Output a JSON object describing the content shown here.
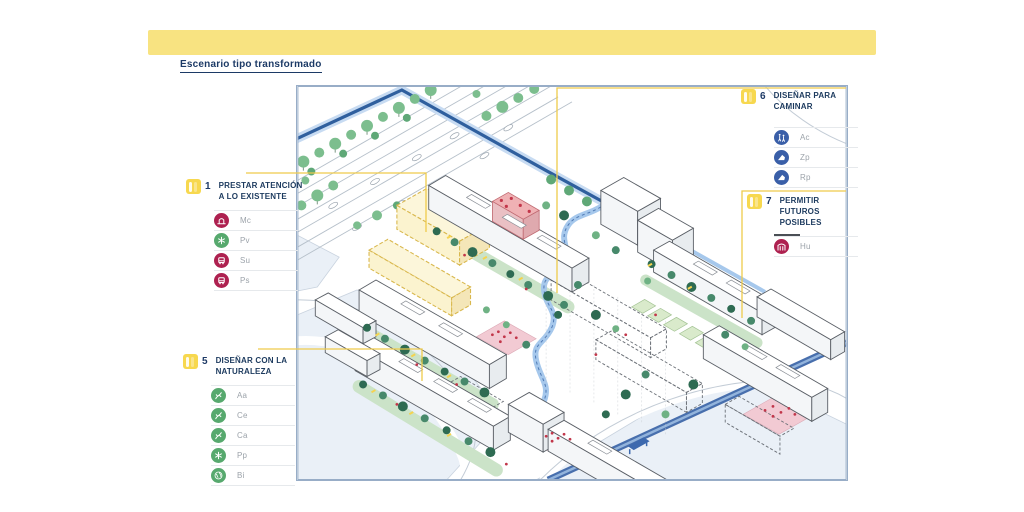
{
  "title": "Escenario tipo transformado",
  "callouts": {
    "c1": {
      "number": "1",
      "title": "PRESTAR ATENCIÓN A LO EXISTENTE",
      "items": [
        {
          "code": "Mc",
          "icon": "monument-icon",
          "color": "#AE2150"
        },
        {
          "code": "Pv",
          "icon": "plant-icon",
          "color": "#57A96E"
        },
        {
          "code": "Su",
          "icon": "bus-icon",
          "color": "#AE2150"
        },
        {
          "code": "Ps",
          "icon": "bus-icon",
          "color": "#AE2150"
        }
      ]
    },
    "c5": {
      "number": "5",
      "title": "DISEÑAR CON LA NATURALEZA",
      "items": [
        {
          "code": "Aa",
          "icon": "branch-icon",
          "color": "#57A96E"
        },
        {
          "code": "Ce",
          "icon": "branch-icon",
          "color": "#57A96E"
        },
        {
          "code": "Ca",
          "icon": "branch-icon",
          "color": "#57A96E"
        },
        {
          "code": "Pp",
          "icon": "plant-icon",
          "color": "#57A96E"
        },
        {
          "code": "Bi",
          "icon": "globe-icon",
          "color": "#57A96E"
        }
      ]
    },
    "c6": {
      "number": "6",
      "title": "DISEÑAR PARA CAMINAR",
      "items": [
        {
          "code": "Ac",
          "icon": "pedestrians-icon",
          "color": "#3A5FA8"
        },
        {
          "code": "Zp",
          "icon": "footpath-icon",
          "color": "#3A5FA8"
        },
        {
          "code": "Rp",
          "icon": "footpath-icon",
          "color": "#3A5FA8"
        }
      ]
    },
    "c7": {
      "number": "7",
      "title": "PERMITIR FUTUROS POSIBLES",
      "items": [
        {
          "code": "Hu",
          "icon": "arch-icon",
          "color": "#AE2150"
        }
      ]
    }
  },
  "colors": {
    "banner": "#F8E381",
    "badge_yellow": "#F7D84F",
    "connector_yellow": "#EFCB4B",
    "navy_text": "#1C3A5E",
    "label_gray": "#9CA3AA",
    "crimson": "#AE2150",
    "green": "#57A96E",
    "blue": "#3A5FA8",
    "map_border": "#98ADC7",
    "canal_blue": "#2F5F9E",
    "path_blue": "#A6C8EC",
    "highlight_yellow_fill": "#FBF3CF",
    "highlight_red_fill": "#EFB1B4",
    "plaza_pink": "#F2CAD3",
    "tree_dark": "#2E6B52",
    "tree_light": "#7CBE8E",
    "ground": "#EAF0F7"
  }
}
